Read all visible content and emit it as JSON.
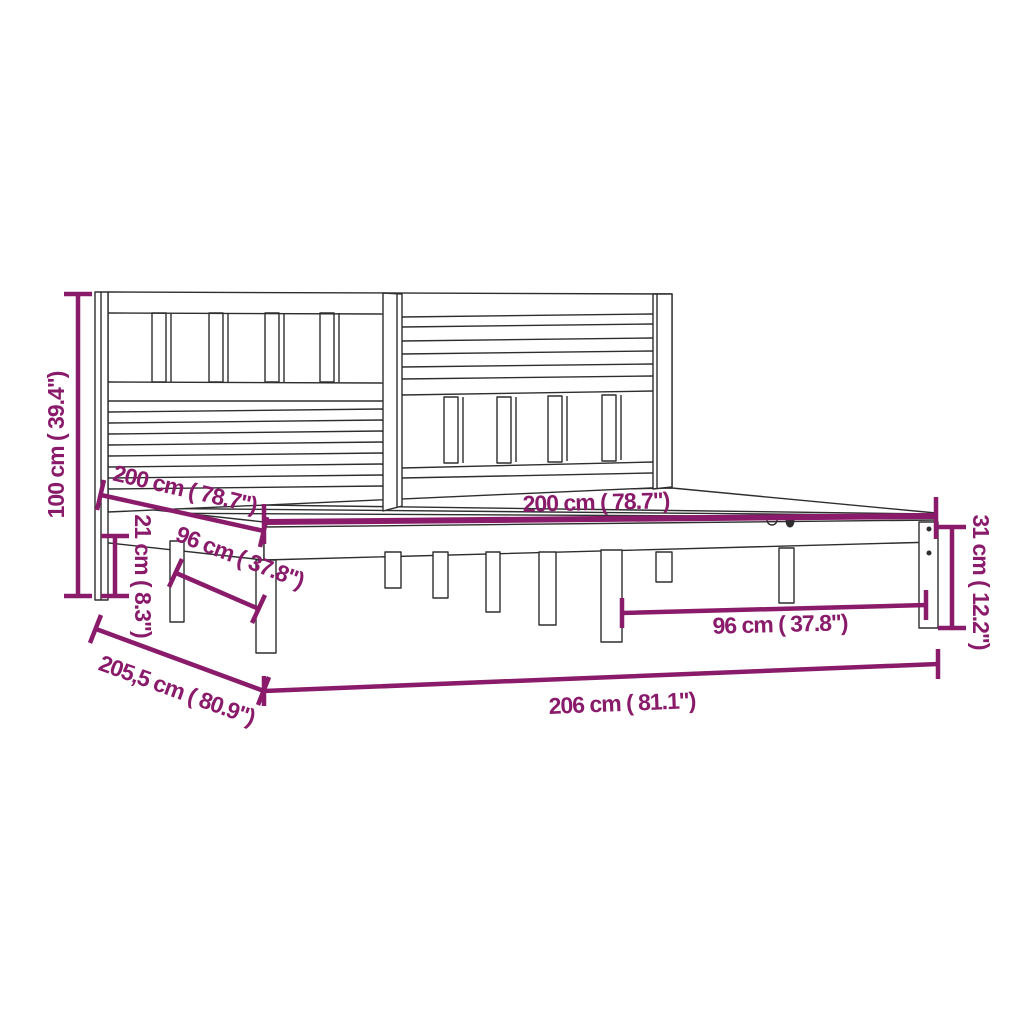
{
  "figure": {
    "type": "product dimension diagram",
    "subject": "wooden bed frame with headboard",
    "colors": {
      "background": "#FFFFFF",
      "line_art": "#2E2E2E",
      "dimension_accent": "#8A1B6B"
    }
  },
  "dimensions": {
    "headboard_height": "100 cm ( 39.4\")",
    "mattress_length": "200 cm ( 78.7\")",
    "ground_clearance": "21 cm ( 8.3\")",
    "leg_spacing_left": "96 cm ( 37.8\")",
    "mattress_width": "200 cm ( 78.7\")",
    "leg_spacing_right": "96 cm ( 37.8\")",
    "frame_height": "31 cm ( 12.2\")",
    "frame_depth": "205,5 cm ( 80.9\")",
    "frame_width": "206 cm ( 81.1\")"
  }
}
